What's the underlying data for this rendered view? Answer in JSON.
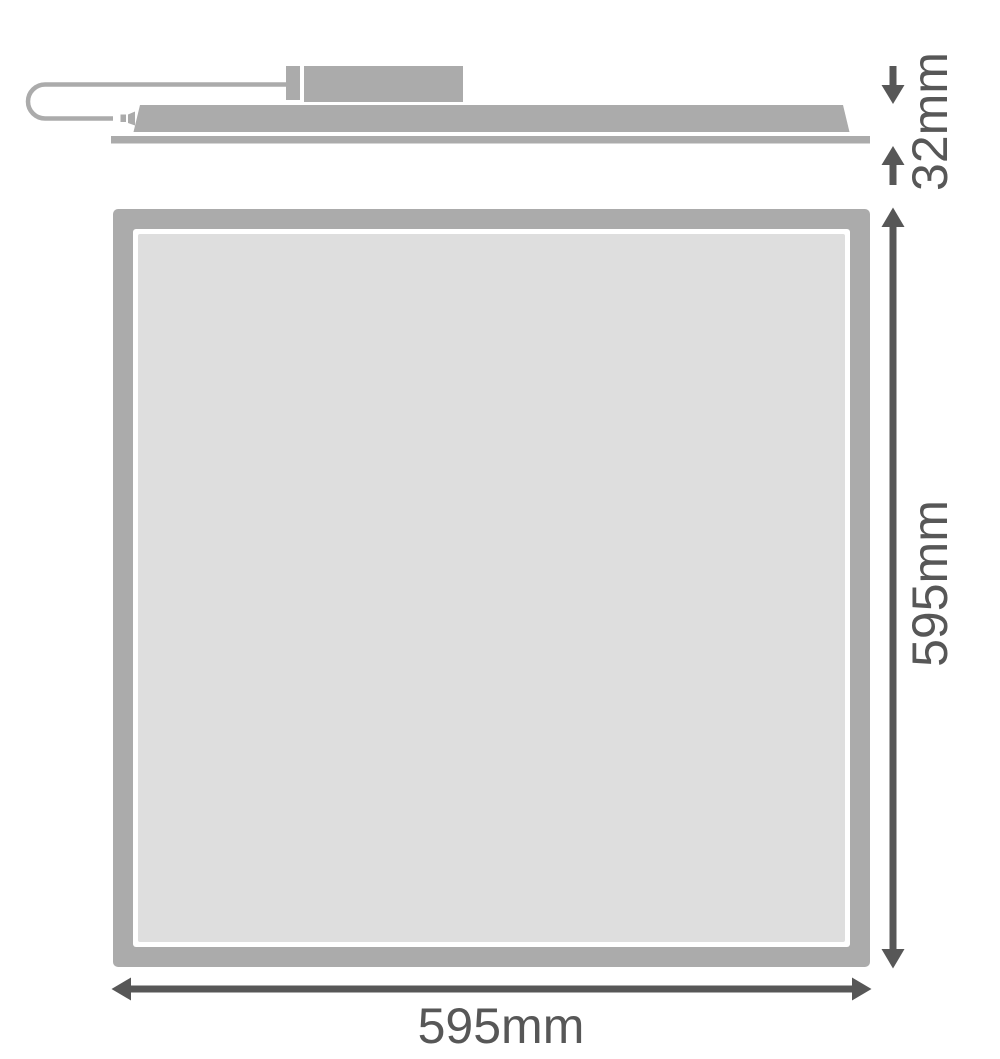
{
  "drawing": {
    "title": "LED panel luminaire dimension drawing",
    "views": {
      "side": {
        "name": "side profile view",
        "parts": [
          "power-cable",
          "plug",
          "driver-box",
          "panel-body",
          "panel-face-edge"
        ]
      },
      "front": {
        "name": "front view",
        "parts": [
          "panel-frame",
          "panel-diffuser"
        ]
      }
    },
    "dimensions": {
      "height": {
        "value": "32mm"
      },
      "side_length": {
        "value": "595mm"
      },
      "width": {
        "value": "595mm"
      }
    },
    "colors": {
      "part_gray": "#ababab",
      "diffuser_gray": "#dedede",
      "dimension_gray": "#575757",
      "background": "#ffffff"
    }
  }
}
